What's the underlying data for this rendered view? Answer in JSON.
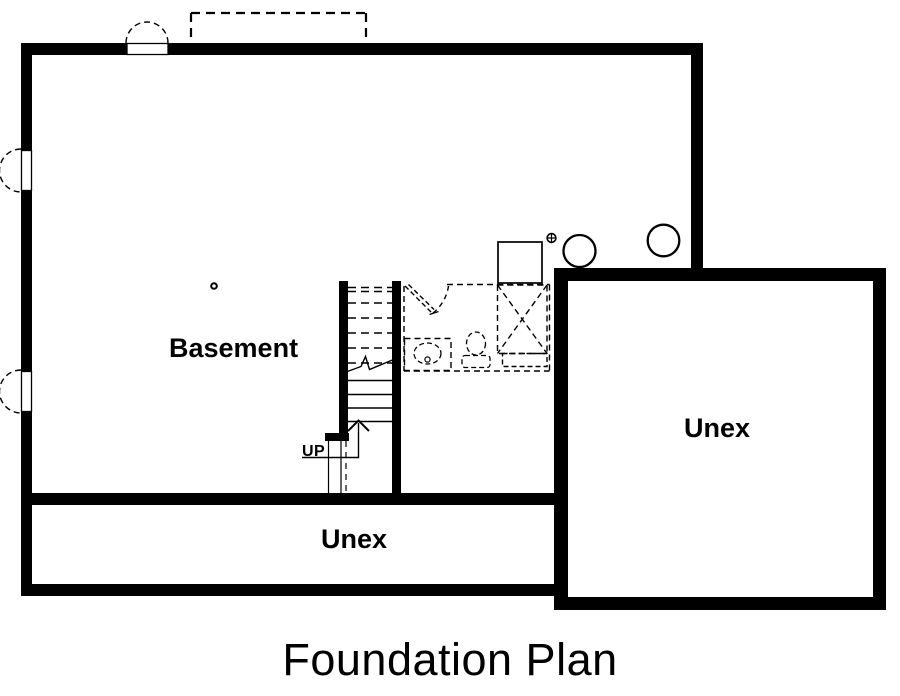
{
  "title": "Foundation Plan",
  "rooms": {
    "basement": {
      "label": "Basement"
    },
    "unex_lower": {
      "label": "Unex"
    },
    "unex_right": {
      "label": "Unex"
    }
  },
  "stairs": {
    "up_label": "UP"
  },
  "colors": {
    "ink": "#000000",
    "paper": "#ffffff"
  },
  "symbols": [
    "basement-window-icon",
    "window-areaway-arc-icon",
    "porch-outline-icon",
    "stair-run-icon",
    "stair-break-line-icon",
    "up-arrow-icon",
    "door-swing-icon",
    "vanity-sink-icon",
    "toilet-icon",
    "shower-icon",
    "furnace-icon",
    "floor-drain-icon",
    "lally-column-icon",
    "point-marker-icon"
  ]
}
